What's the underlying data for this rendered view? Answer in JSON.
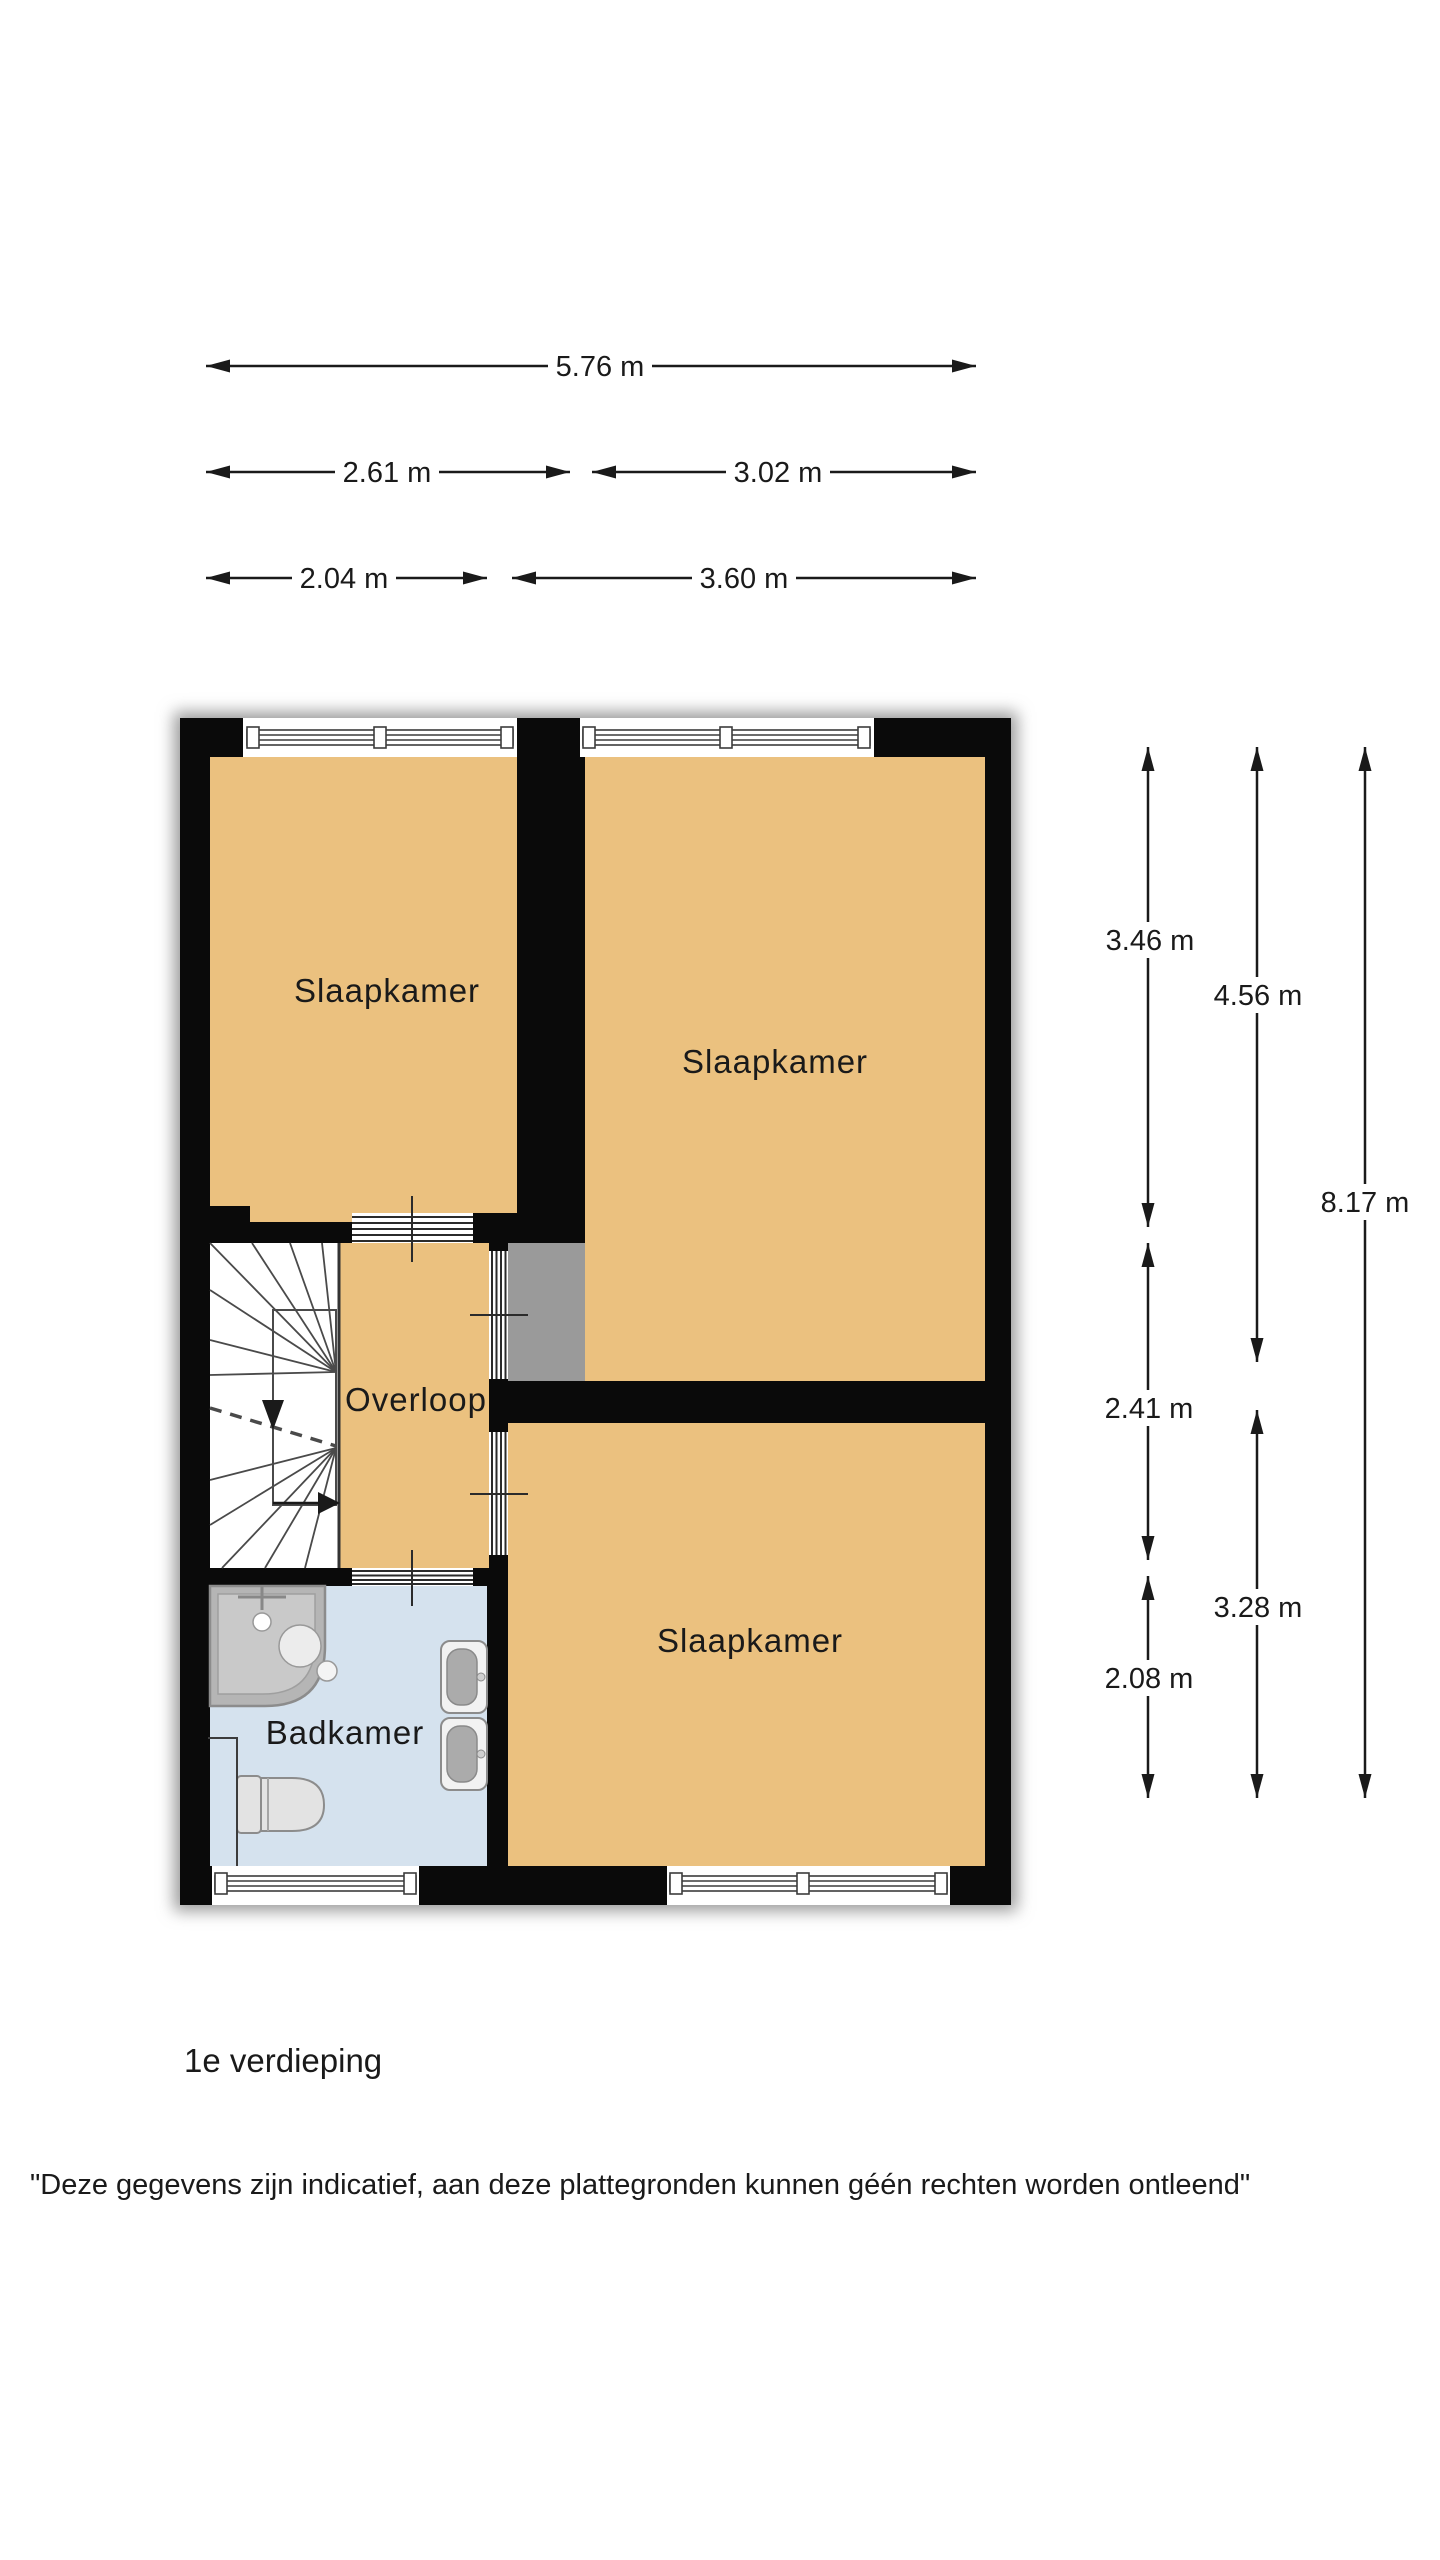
{
  "rooms": {
    "bedroom_top_left": "Slaapkamer",
    "bedroom_top_right": "Slaapkamer",
    "bedroom_bottom_right": "Slaapkamer",
    "landing": "Overloop",
    "bathroom": "Badkamer"
  },
  "dimensions": {
    "top": [
      {
        "label": "5.76 m"
      },
      {
        "label": "2.61 m"
      },
      {
        "label": "3.02 m"
      },
      {
        "label": "2.04 m"
      },
      {
        "label": "3.60 m"
      }
    ],
    "right": [
      {
        "label": "3.46 m"
      },
      {
        "label": "4.56 m"
      },
      {
        "label": "8.17 m"
      },
      {
        "label": "2.41 m"
      },
      {
        "label": "3.28 m"
      },
      {
        "label": "2.08 m"
      }
    ]
  },
  "footer": {
    "floor_label": "1e verdieping",
    "disclaimer": "\"Deze gegevens zijn indicatief, aan deze plattegronden kunnen géén rechten worden ontleend\""
  },
  "colors": {
    "room_fill": "#EBC17F",
    "bathroom_fill": "#D5E2EE",
    "wall": "#0A0A0A",
    "shower_fill": "#B5B5B5",
    "shower_tray": "#C9C9C9",
    "fixture_fill": "#E3E3E3",
    "fixture_stroke": "#8C8C8C",
    "dimension_color": "#1A1A1A",
    "background": "#FFFFFF"
  }
}
